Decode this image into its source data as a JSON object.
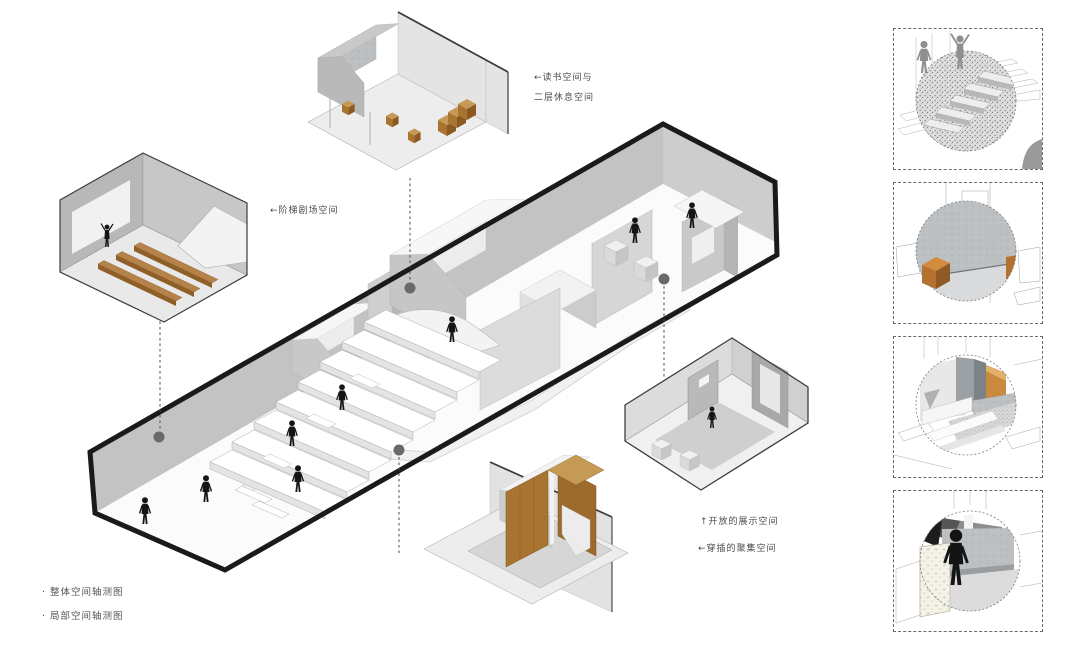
{
  "page": {
    "type": "architectural axonometric diagram",
    "background": "#ffffff"
  },
  "callouts": {
    "reading_space": {
      "line1": "←读书空间与",
      "line2": "二层休息空间"
    },
    "stepped_theater": {
      "label": "←阶梯剧场空间"
    },
    "open_display": {
      "label": "↑开放的展示空间"
    },
    "interspersed_gathering": {
      "label": "←穿插的聚集空间"
    }
  },
  "legend": {
    "overall": "· 整体空间轴测图",
    "partial": "· 局部空间轴测图"
  },
  "colors": {
    "outline": "#1a1a1a",
    "wall_gray": "#c3c3c3",
    "floor": "#fbfbfb",
    "wood": "#a9742f",
    "wood_light": "#c49a55",
    "wood_dark": "#7e531f",
    "accent_orange": "#b5722e",
    "marker_dot": "#696969",
    "label_text": "#4d4d4d"
  },
  "main_view": {
    "name": "overall-space-axonometric",
    "callout_markers": 4
  },
  "detail_views": [
    {
      "name": "stepped-theater-room"
    },
    {
      "name": "reading-and-rest-space"
    },
    {
      "name": "wooden-display-structure"
    },
    {
      "name": "gathering-room"
    }
  ],
  "photo_details": [
    {
      "name": "terrazzo-stair-closeup"
    },
    {
      "name": "concrete-wall-wood-stool-closeup"
    },
    {
      "name": "corner-threshold-closeup"
    },
    {
      "name": "pebble-wall-figure-closeup"
    }
  ]
}
